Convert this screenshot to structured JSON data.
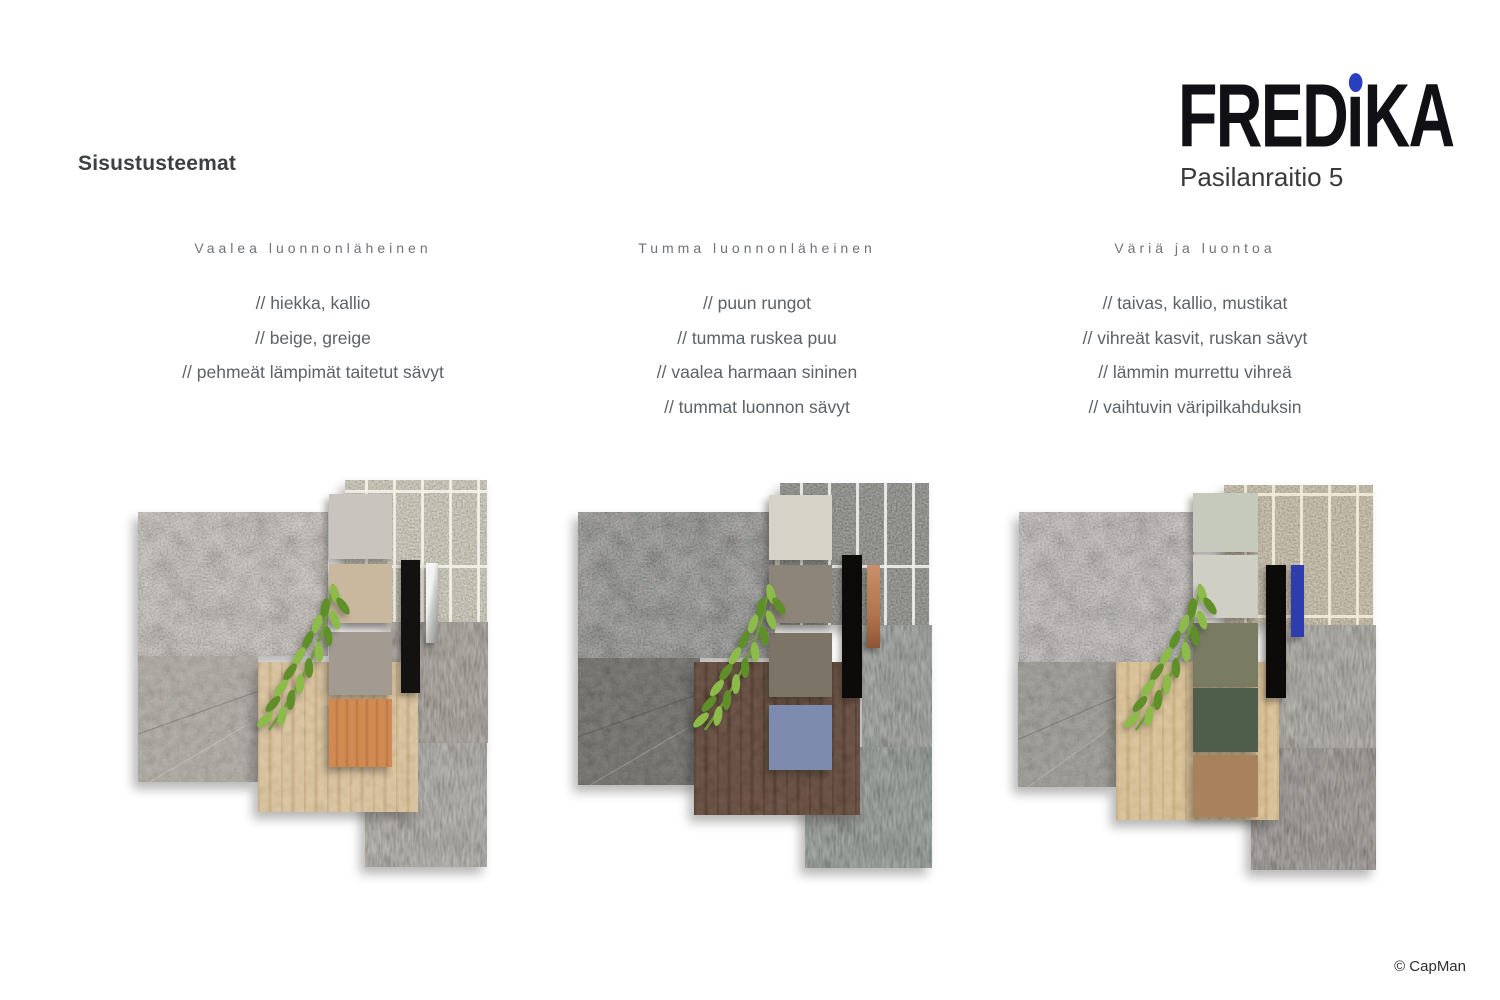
{
  "page": {
    "title": "Sisustusteemat",
    "copyright": "© CapMan",
    "background": "#ffffff",
    "title_color": "#3d4043",
    "header_color": "#6e7378",
    "bullet_color": "#5d6266",
    "copyright_color": "#2f2f2f"
  },
  "logo": {
    "wordmark_pre": "FRED",
    "wordmark_post": "KA",
    "subtitle": "Pasilanraitio 5",
    "letter_color": "#101015",
    "dot_color": "#2a3fbe",
    "subtitle_color": "#3a3a3c"
  },
  "columns": [
    {
      "header": "Vaalea luonnonläheinen",
      "bullets": [
        "// hiekka, kallio",
        "// beige, greige",
        "// pehmeät lämpimät taitetut sävyt"
      ]
    },
    {
      "header": "Tumma luonnonläheinen",
      "bullets": [
        "// puun rungot",
        "// tumma ruskea puu",
        "// vaalea harmaan sininen",
        "// tummat luonnon sävyt"
      ]
    },
    {
      "header": "Väriä ja luontoa",
      "bullets": [
        "// taivas, kallio, mustikat",
        "// vihreät kasvit, ruskan sävyt",
        "// lämmin murrettu vihreä",
        "// vaihtuvin väripilkahduksin"
      ]
    }
  ],
  "boards": [
    {
      "theme": "Vaalea luonnonläheinen",
      "stone": "#b3a496",
      "concrete": "#a49e95",
      "mosaic": "#c6c2a8",
      "mosaic_grout": "#f3f1e7",
      "carpet_upper": "#84796b",
      "carpet_lower": "#8d8880",
      "wood": "#dcc49c",
      "wood_grain": "#c9ab7d",
      "swatches": [
        "#c9c5be",
        "#c9b79e",
        "#a39b91",
        "#d18a51"
      ],
      "wood_grain_swatch": 3,
      "black_bar": "#141210",
      "accent": {
        "type": "chrome",
        "colors": [
          "#f4f4f4",
          "#c9c9c9",
          "#8a8a8a"
        ]
      }
    },
    {
      "theme": "Tumma luonnonläheinen",
      "stone": "#3c3a37",
      "concrete": "#565450",
      "mosaic": "#64665f",
      "mosaic_grout": "#edeee8",
      "carpet_upper": "#6d746d",
      "carpet_lower": "#5f6862",
      "wood": "#5e4334",
      "wood_grain": "#48301f",
      "swatches": [
        "#d6d2c8",
        "#8d8579",
        "#7b7467",
        "#7c8bae"
      ],
      "wood_grain_swatch": -1,
      "black_bar": "#0c0b0a",
      "accent": {
        "type": "copper",
        "colors": [
          "#c98f68",
          "#b0754e",
          "#8d5534"
        ]
      }
    },
    {
      "theme": "Väriä ja luontoa",
      "stone": "#a59c99",
      "concrete": "#8e8b82",
      "mosaic": "#bfae8d",
      "mosaic_grout": "#f2ead8",
      "carpet_upper": "#8a857b",
      "carpet_lower": "#6b635c",
      "wood": "#ddc294",
      "wood_grain": "#c9ab79",
      "swatches": [
        "#c5cabc",
        "#d0cfc6",
        "#797b62",
        "#4e5e4b",
        "#a8825c"
      ],
      "wood_grain_swatch": -1,
      "black_bar": "#0c0b0a",
      "accent": {
        "type": "blue",
        "colors": [
          "#3545b2",
          "#2e3cae",
          "#2a37a4"
        ]
      }
    }
  ],
  "plant": {
    "leaf_light": "#8cbb4a",
    "leaf_dark": "#5f8f28",
    "stem": "#6f9c33"
  }
}
